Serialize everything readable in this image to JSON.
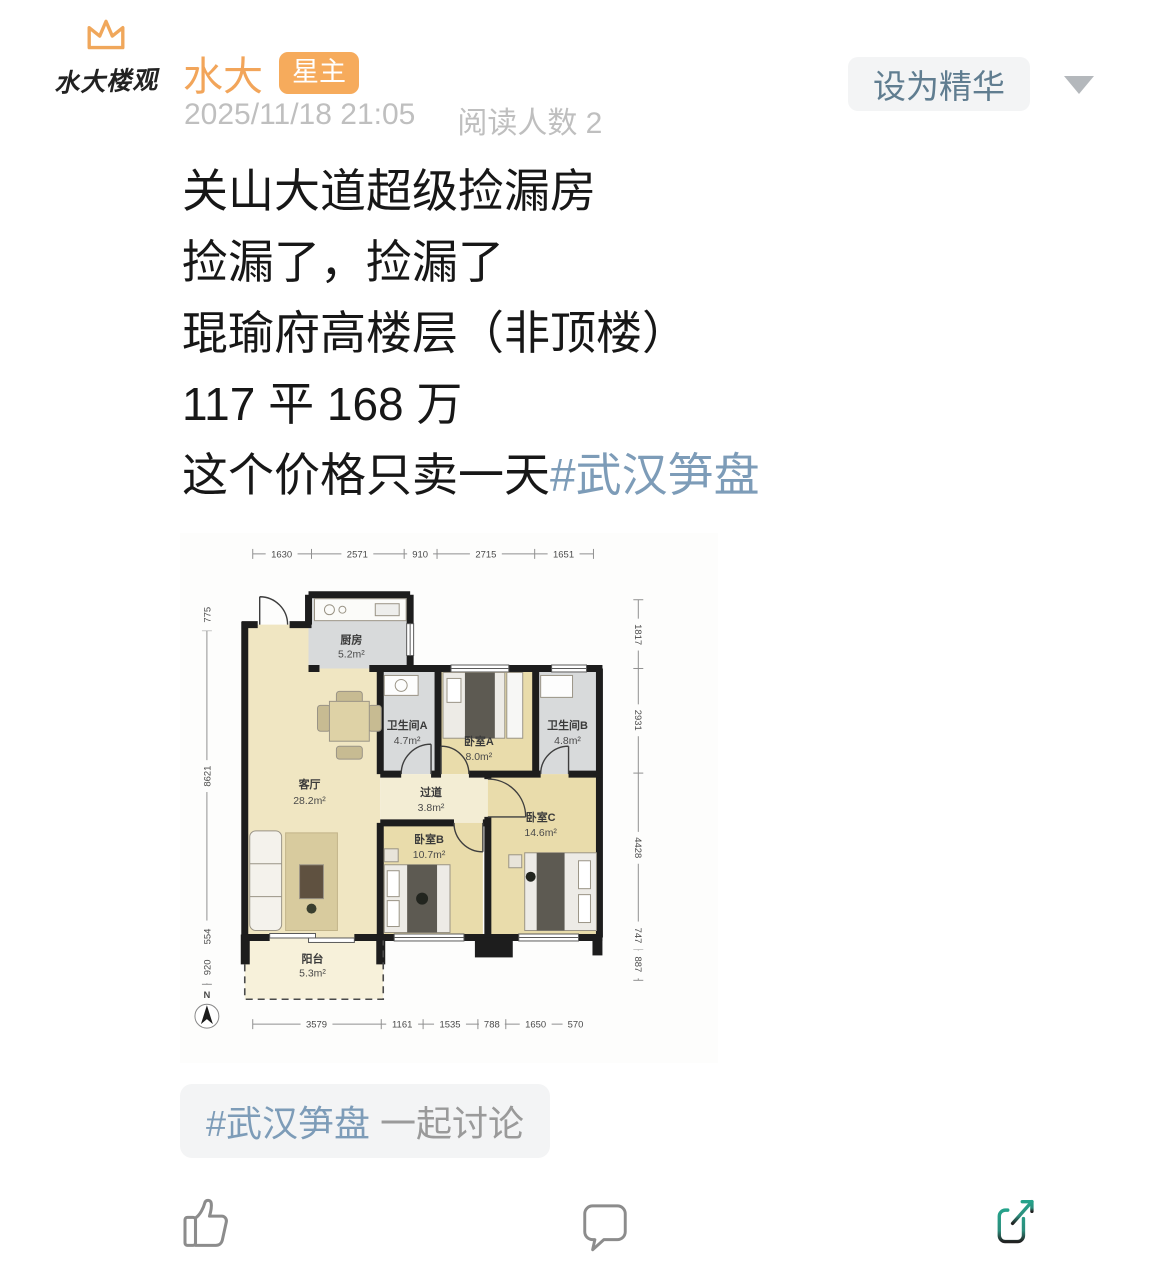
{
  "header": {
    "avatar_caption": "水大楼观",
    "username": "水大",
    "badge": "星主",
    "timestamp": "2025/11/18 21:05",
    "read_count": "阅读人数 2",
    "feature_button": "设为精华"
  },
  "post": {
    "line1": "关山大道超级捡漏房",
    "line2": "捡漏了，捡漏了",
    "line3": "琨瑜府高楼层（非顶楼）",
    "line4": "117 平 168 万",
    "line5": "这个价格只卖一天",
    "hashtag": "#武汉笋盘"
  },
  "floorplan": {
    "rooms": {
      "kitchen": {
        "name": "厨房",
        "area": "5.2m²"
      },
      "bath_a": {
        "name": "卫生间A",
        "area": "4.7m²"
      },
      "bed_a": {
        "name": "卧室A",
        "area": "8.0m²"
      },
      "bath_b": {
        "name": "卫生间B",
        "area": "4.8m²"
      },
      "living": {
        "name": "客厅",
        "area": "28.2m²"
      },
      "corridor": {
        "name": "过道",
        "area": "3.8m²"
      },
      "bed_c": {
        "name": "卧室C",
        "area": "14.6m²"
      },
      "bed_b": {
        "name": "卧室B",
        "area": "10.7m²"
      },
      "balcony": {
        "name": "阳台",
        "area": "5.3m²"
      }
    },
    "dims": {
      "top": [
        "1630",
        "2571",
        "910",
        "2715",
        "1651"
      ],
      "bottom": [
        "3579",
        "1161",
        "1535",
        "788",
        "1650",
        "570"
      ],
      "left": [
        "775",
        "8621",
        "554",
        "920"
      ],
      "right": [
        "1817",
        "2931",
        "4428",
        "747",
        "887"
      ]
    },
    "north": "N"
  },
  "tag_bar": {
    "hashtag": "#武汉笋盘",
    "suffix": " 一起讨论"
  },
  "icons": {
    "crown": "crown-icon",
    "dropdown": "chevron-down-icon",
    "like": "thumbs-up-icon",
    "comment": "comment-bubble-icon",
    "share": "share-arrow-icon",
    "north_compass": "north-compass-icon"
  },
  "colors": {
    "accent_orange": "#f2a75c",
    "hashtag_blue": "#7d9cb8",
    "share_teal": "#25a38b",
    "text_dark": "#1a1a1a",
    "text_gray": "#bfbfbf",
    "button_text": "#607d90",
    "pill_bg": "#f3f4f5"
  }
}
